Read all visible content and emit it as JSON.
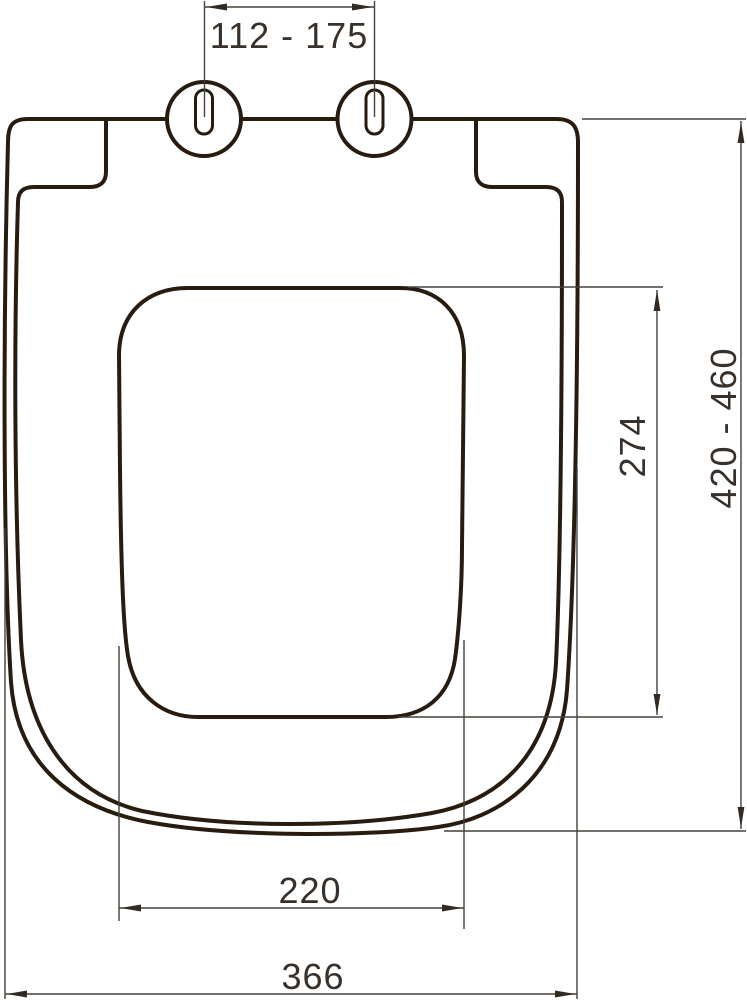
{
  "drawing": {
    "type": "technical-dimension-drawing",
    "subject": "toilet-seat-with-lid-top-view"
  },
  "dimensions": {
    "hinge_spacing": {
      "label": "112 - 175",
      "orientation": "horizontal",
      "location": "top"
    },
    "overall_length": {
      "label": "420 - 460",
      "orientation": "vertical",
      "location": "right-outer"
    },
    "opening_length": {
      "label": "274",
      "orientation": "vertical",
      "location": "right-inner"
    },
    "opening_width": {
      "label": "220",
      "orientation": "horizontal",
      "location": "bottom-inner"
    },
    "overall_width": {
      "label": "366",
      "orientation": "horizontal",
      "location": "bottom-outer"
    }
  },
  "colors": {
    "outline": "#281b10",
    "dimension_line": "#45403a",
    "label_text": "#38302a",
    "background": "#ffffff"
  }
}
